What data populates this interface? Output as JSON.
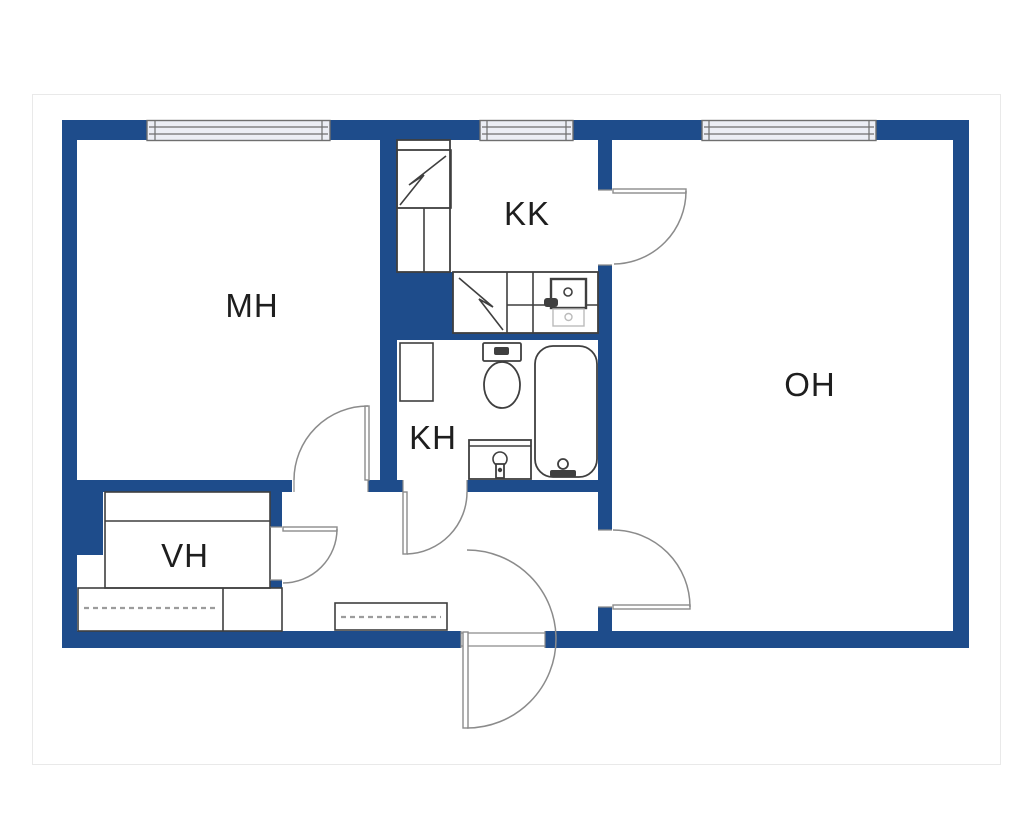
{
  "meta": {
    "width": 1024,
    "height": 829,
    "kind": "apartment floor plan"
  },
  "palette": {
    "background": "#ffffff",
    "panel_border": "#e9e9e9",
    "wall": "#1e4c8b",
    "window_fill": "#eceef5",
    "window_stroke": "#6f6f6f",
    "fixture_stroke": "#3f3f3f",
    "faint_stroke": "#bbbbbb",
    "door_stroke": "#8b8b8b",
    "dash_stroke": "#9c9c9c",
    "label": "#1e1e1e"
  },
  "floorplan": {
    "rooms": [
      {
        "id": "mh",
        "label": "MH"
      },
      {
        "id": "kk",
        "label": "KK"
      },
      {
        "id": "kh",
        "label": "KH"
      },
      {
        "id": "vh",
        "label": "VH"
      },
      {
        "id": "oh",
        "label": "OH"
      }
    ]
  }
}
